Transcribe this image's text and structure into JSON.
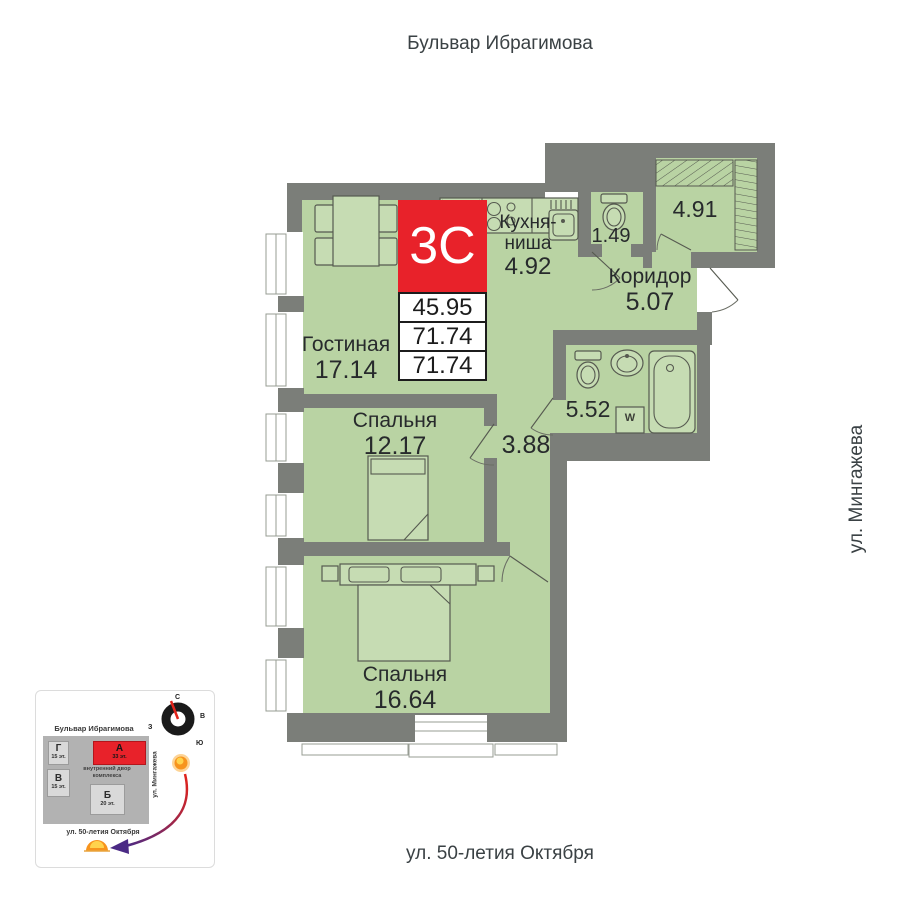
{
  "streets": {
    "top": "Бульвар Ибрагимова",
    "right": "ул. Мингажева",
    "bottom": "ул. 50-летия Октября"
  },
  "badge": {
    "plan_type": "3С",
    "areas": [
      "45.95",
      "71.74",
      "71.74"
    ]
  },
  "rooms": {
    "living": {
      "name": "Гостиная",
      "area": "17.14"
    },
    "kitchen": {
      "name": "Кухня-ниша",
      "area": "4.92"
    },
    "wc": {
      "area": "1.49"
    },
    "dressing": {
      "area": "4.91"
    },
    "corridor": {
      "name": "Коридор",
      "area": "5.07"
    },
    "bathroom": {
      "area": "5.52"
    },
    "hall": {
      "area": "3.88"
    },
    "bedroom1": {
      "name": "Спальня",
      "area": "12.17"
    },
    "bedroom2": {
      "name": "Спальня",
      "area": "16.64"
    }
  },
  "fixtures": {
    "washer": "W"
  },
  "minimap": {
    "street_top": "Бульвар Ибрагимова",
    "street_right": "ул. Мингажева",
    "street_bottom": "ул. 50-летия Октября",
    "courtyard": "внутренний двор комплекса",
    "buildings": [
      {
        "label": "Г",
        "floors": "15 эт.",
        "highlight": false
      },
      {
        "label": "В",
        "floors": "15 эт.",
        "highlight": false
      },
      {
        "label": "А",
        "floors": "33 эт.",
        "highlight": true
      },
      {
        "label": "Б",
        "floors": "20 эт.",
        "highlight": false
      }
    ],
    "compass": {
      "n": "С",
      "e": "В",
      "s": "Ю",
      "w": "З"
    }
  },
  "colors": {
    "accent_red": "#e8222a",
    "wall_gray": "#7b7e79",
    "room_green": "#b9d3a3"
  }
}
